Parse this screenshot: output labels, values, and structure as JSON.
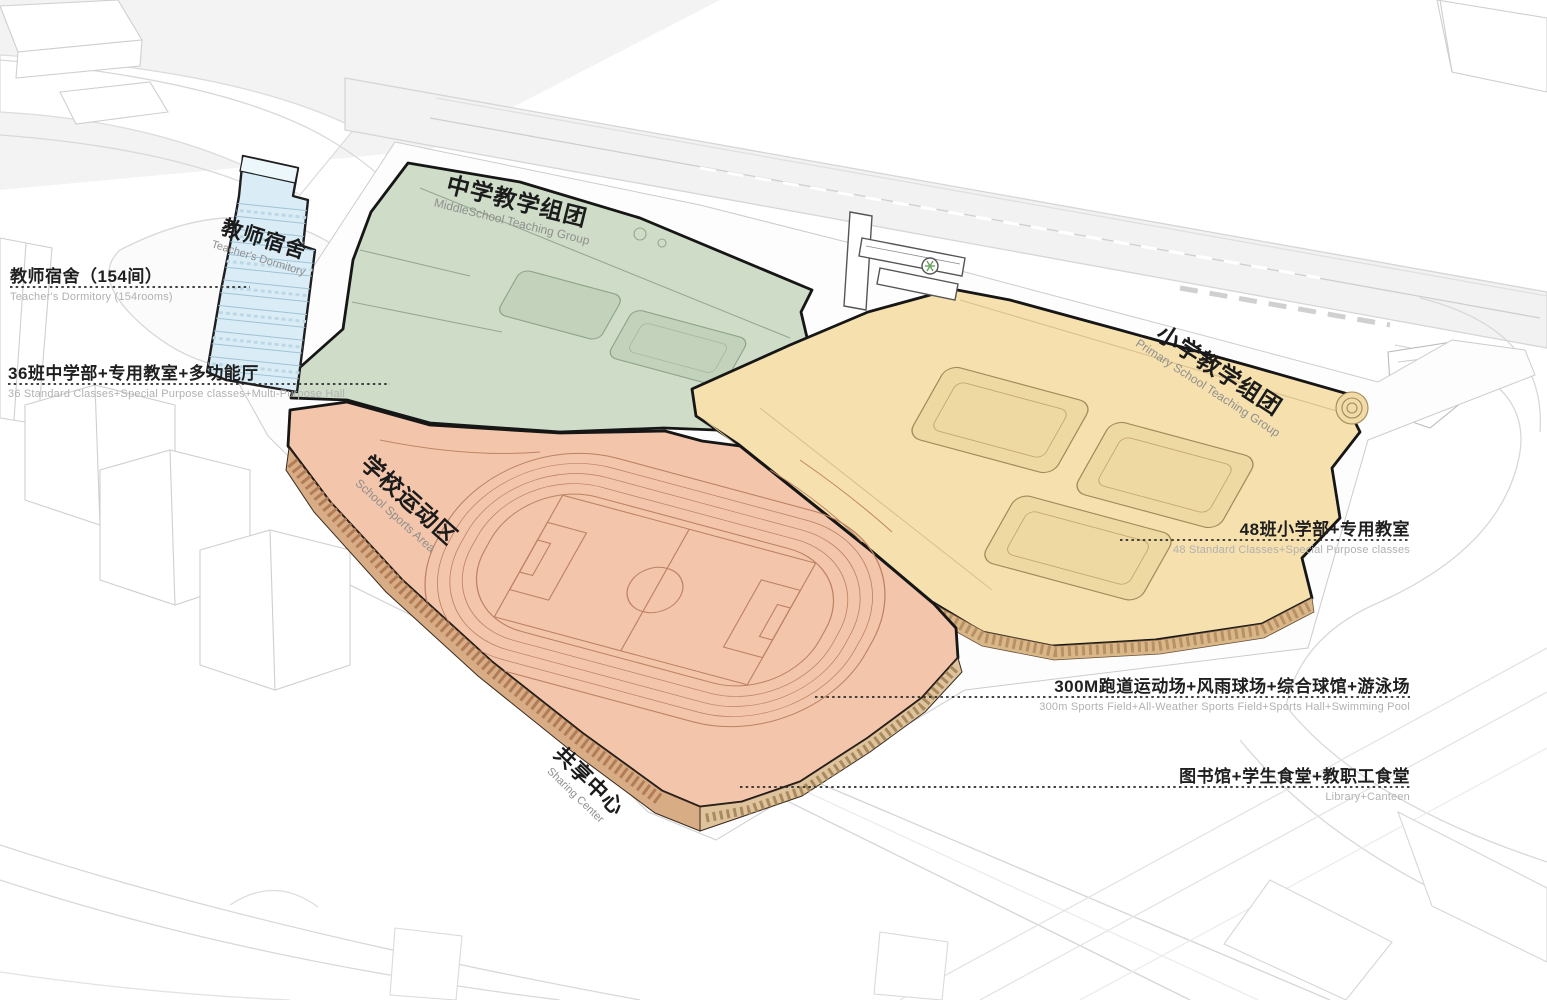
{
  "zone_labels": {
    "dormitory": {
      "zh": "教师宿舍",
      "en": "Teacher's Dormitory"
    },
    "middle_school": {
      "zh": "中学教学组团",
      "en": "MiddleSchool Teaching Group"
    },
    "primary_school": {
      "zh": "小学教学组团",
      "en": "Primary School Teaching Group"
    },
    "sports": {
      "zh": "学校运动区",
      "en": "School Sports Area"
    },
    "sharing": {
      "zh": "共享中心",
      "en": "Sharing Center"
    }
  },
  "annotations": {
    "dormitory": {
      "zh": "教师宿舍（154间）",
      "en": "Teacher's Dormitory (154rooms)"
    },
    "middle": {
      "zh": "36班中学部+专用教室+多功能厅",
      "en": "36 Standard Classes+Special Purpose classes+Multi-Purpose Hall"
    },
    "primary": {
      "zh": "48班小学部+专用教室",
      "en": "48 Standard Classes+Special Purpose classes"
    },
    "sports": {
      "zh": "300M跑道运动场+风雨球场+综合球馆+游泳场",
      "en": "300m Sports Field+All-Weather Sports Field+Sports Hall+Swimming Pool"
    },
    "library": {
      "zh": "图书馆+学生食堂+教职工食堂",
      "en": "Library+Canteen"
    }
  },
  "legend_colors": {
    "dormitory_blue": "#daedf6",
    "middle_green": "#cfdcc8",
    "primary_yellow": "#f6e1ae",
    "sports_salmon": "#f3c5aa",
    "facade_tan": "#d9b088",
    "outline_black": "#161616",
    "context_gray": "#d4d4d4"
  }
}
